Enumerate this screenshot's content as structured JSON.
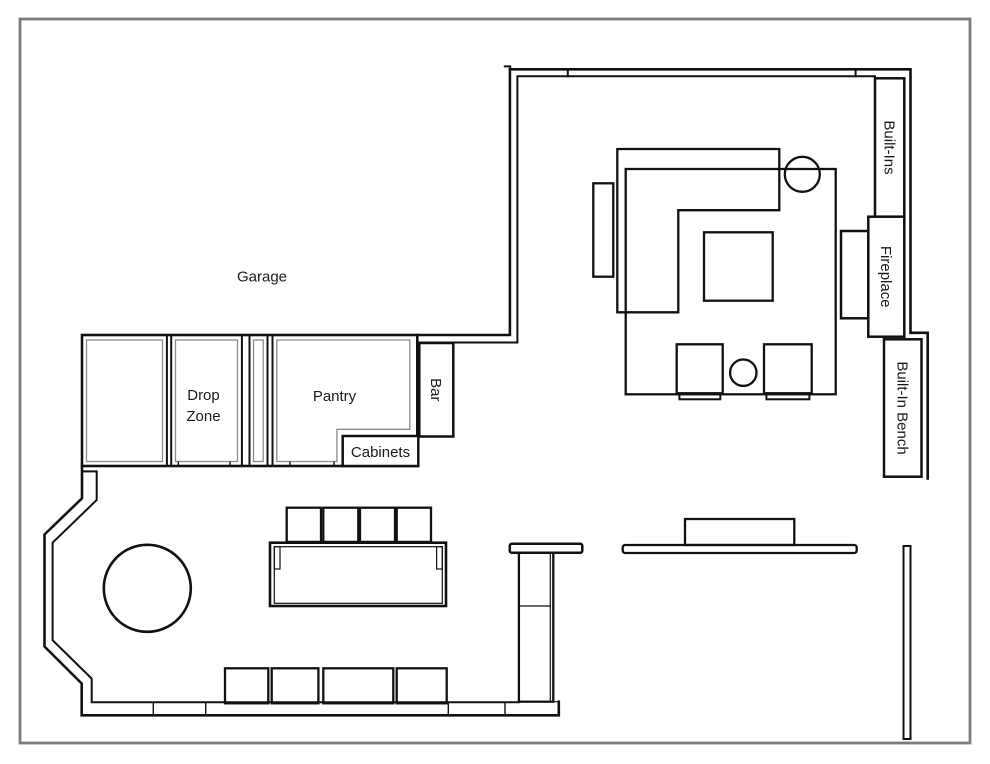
{
  "colors": {
    "wall": "#111111",
    "ink": "#1a1a1a",
    "thin": "#8c8c8c",
    "frame": "#7c7c7c",
    "background": "#ffffff"
  },
  "labels": {
    "garage": "Garage",
    "drop_zone_lines": [
      "Drop",
      "Zone"
    ],
    "pantry": "Pantry",
    "bar": "Bar",
    "cabinets": "Cabinets",
    "built_ins": "Built-Ins",
    "fireplace": "Fireplace",
    "built_in_bench": "Built-In Bench"
  }
}
